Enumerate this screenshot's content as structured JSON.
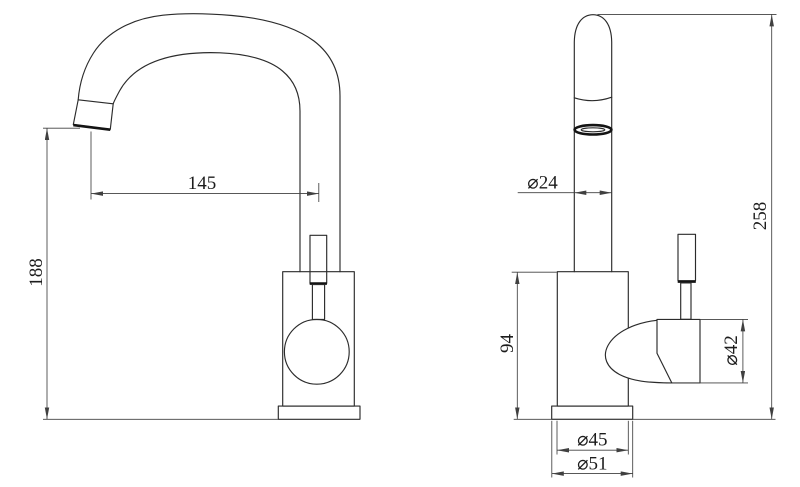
{
  "drawing": {
    "title": "faucet-two-view-dimension-drawing",
    "background": "#ffffff",
    "line_color": "#2b2b2b",
    "dimension_line_color": "#404040",
    "text_color": "#1c1c1c",
    "views": {
      "side_view": {
        "name": "side view (spout profile)",
        "dimensions": {
          "spout_reach": "145",
          "height_to_spout": "188"
        }
      },
      "front_view": {
        "name": "front view (body and handle)",
        "dimensions": {
          "spout_tube_diameter": "⌀24",
          "total_height": "258",
          "body_height": "94",
          "handle_diameter": "⌀42",
          "body_diameter": "⌀45",
          "base_diameter": "⌀51"
        }
      }
    }
  }
}
